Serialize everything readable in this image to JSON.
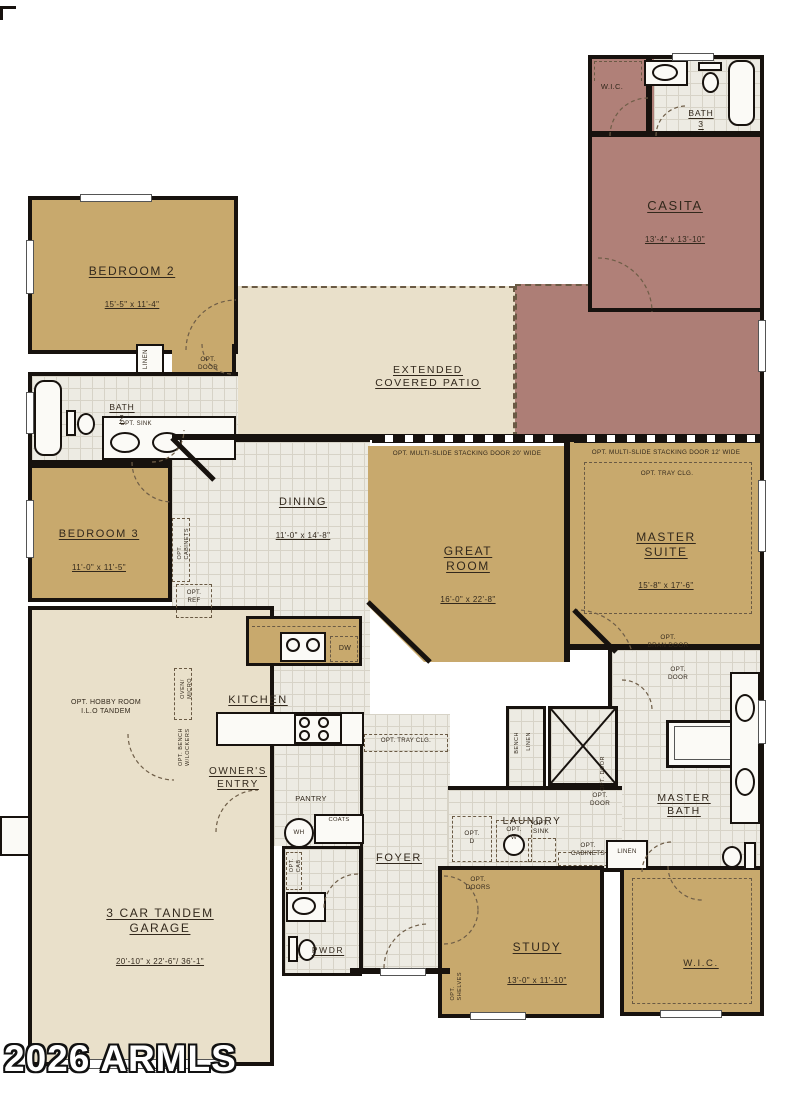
{
  "watermark": "2026 ARMLS",
  "colors": {
    "wall": "#17120e",
    "ink": "#32281c",
    "room-tan": "#c8a96d",
    "casita-mauve": "#b08078",
    "patio-mauve": "#ad7e76",
    "patio-beige": "#e9e0ca",
    "tile": "#edebe3"
  },
  "rooms": {
    "casita": {
      "name": "CASITA",
      "dims": "13'-4\" x 13'-10\""
    },
    "casita_wic": {
      "name": "W.I.C."
    },
    "bath3": {
      "name": "BATH\n3"
    },
    "bedroom2": {
      "name": "BEDROOM 2",
      "dims": "15'-5\" x 11'-4\""
    },
    "bath2": {
      "name": "BATH\n2"
    },
    "bedroom3": {
      "name": "BEDROOM 3",
      "dims": "11'-0\" x 11'-5\""
    },
    "patio": {
      "name": "EXTENDED\nCOVERED PATIO"
    },
    "dining": {
      "name": "DINING",
      "dims": "11'-0\" x 14'-8\""
    },
    "great_room": {
      "name": "GREAT\nROOM",
      "dims": "16'-0\" x 22'-8\""
    },
    "master_suite": {
      "name": "MASTER\nSUITE",
      "dims": "15'-8\" x 17'-6\""
    },
    "kitchen": {
      "name": "KITCHEN"
    },
    "owners_entry": {
      "name": "OWNER'S\nENTRY"
    },
    "pantry": {
      "name": "PANTRY"
    },
    "foyer": {
      "name": "FOYER"
    },
    "laundry": {
      "name": "LAUNDRY"
    },
    "master_bath": {
      "name": "MASTER\nBATH"
    },
    "garage": {
      "name": "3 CAR TANDEM\nGARAGE",
      "dims": "20'-10\" x 22'-6\"/ 36'-1\""
    },
    "pwdr": {
      "name": "PWDR"
    },
    "study": {
      "name": "STUDY",
      "dims": "13'-0\" x 11'-10\""
    },
    "wic": {
      "name": "W.I.C."
    }
  },
  "annotations": {
    "linen": "LINEN",
    "opt_door": "OPT.\nDOOR",
    "opt_door_line": "OPT. DOOR",
    "opt_doors": "OPT.\nDOORS",
    "opt_sink": "OPT. SINK",
    "opt_sink2": "OPT.\nSINK",
    "stacking_door_20": "OPT. MULTI-SLIDE STACKING DOOR 20' WIDE",
    "stacking_door_12": "OPT. MULTI-SLIDE STACKING DOOR 12' WIDE",
    "opt_tray_clg": "OPT. TRAY CLG.",
    "opt_cabinets": "OPT.\nCABINETS",
    "opt_cabinets_line": "OPT. CABINETS",
    "opt_ref": "OPT.\nREF",
    "oven_micro": "OVEN/\nMICRO",
    "dw": "DW",
    "opt_bench_lockers": "OPT. BENCH\nW/LOCKERS",
    "opt_hobby": "OPT. HOBBY ROOM\nI.L.O TANDEM",
    "opt_bran_door": "OPT.\nBRAN DOOR",
    "bench": "BENCH",
    "opt_d": "OPT.\nD",
    "opt_w": "OPT.\nW",
    "coats": "COATS",
    "wh": "WH",
    "opt_cab": "OPT.\nCAB",
    "opt_shelves": "OPT.\nSHELVES"
  }
}
